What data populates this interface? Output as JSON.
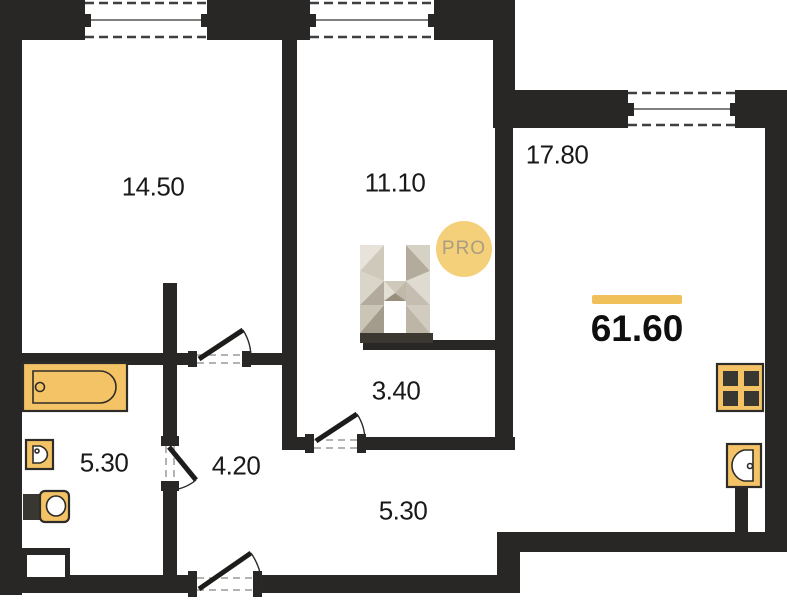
{
  "plan": {
    "total_area": "61.60",
    "rooms": [
      {
        "id": "room-14-50",
        "area": "14.50"
      },
      {
        "id": "room-11-10",
        "area": "11.10"
      },
      {
        "id": "room-17-80",
        "area": "17.80"
      },
      {
        "id": "corridor-3-40",
        "area": "3.40"
      },
      {
        "id": "hall-4-20",
        "area": "4.20"
      },
      {
        "id": "bathroom-5-30",
        "area": "5.30"
      },
      {
        "id": "hallway-5-30",
        "area": "5.30"
      }
    ],
    "watermark": {
      "letter": "H",
      "badge": "PRO"
    },
    "colors": {
      "wall": "#282726",
      "fixture": "#F4C366",
      "accent_bar": "#F0C15B",
      "badge_circle": "#F5D07A"
    }
  }
}
